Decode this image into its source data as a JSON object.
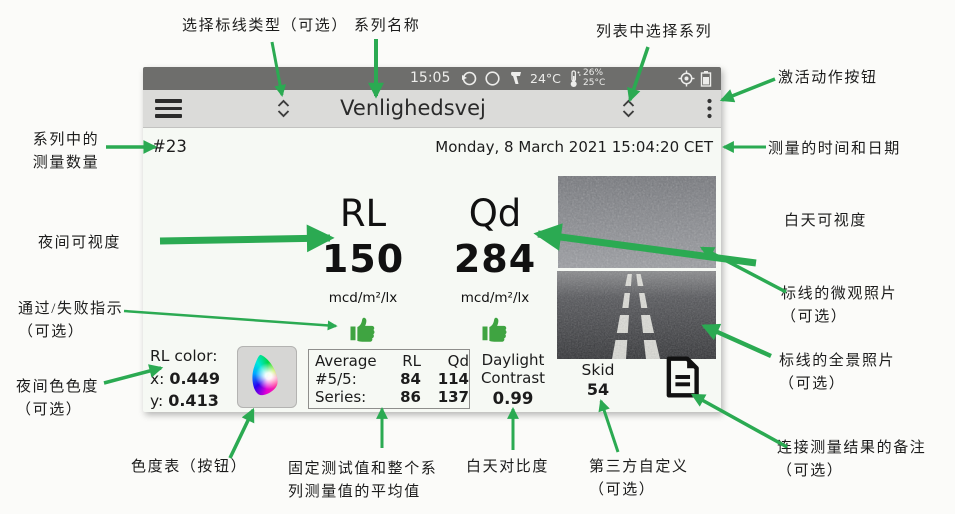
{
  "colors": {
    "arrow": "#2baa52",
    "thumb": "#3fa441",
    "status_bar_bg": "#6e6e6c",
    "menu_bar_bg": "#dbdbd9",
    "screen_bg": "#f6f9f4"
  },
  "icons": {
    "hamburger": "menu",
    "updown_selector": "chevron-up-down",
    "overflow": "vertical-dots",
    "sync": "circular-arrow",
    "mode": "circle",
    "ir_thermometer": "ir-gun",
    "thermometer": "thermometer",
    "gps": "target",
    "battery": "battery",
    "pass": "thumb-up",
    "chromaticity": "cie-horseshoe",
    "notes": "document"
  },
  "device": {
    "status_bar": {
      "time": "15:05",
      "ambient_temp": "24°C",
      "humidity": "26%",
      "road_temp": "25°C"
    },
    "menu_bar": {
      "title": "Venlighedsvej"
    },
    "header": {
      "count": "#23",
      "datetime": "Monday, 8 March 2021 15:04:20 CET"
    },
    "readings": {
      "rl": {
        "label": "RL",
        "value": "150",
        "unit": "mcd/m²/lx"
      },
      "qd": {
        "label": "Qd",
        "value": "284",
        "unit": "mcd/m²/lx"
      }
    },
    "rl_color": {
      "title": "RL color:",
      "x_label": "x:",
      "x_value": "0.449",
      "y_label": "y:",
      "y_value": "0.413"
    },
    "average": {
      "header": {
        "c0": "Average",
        "c1": "RL",
        "c2": "Qd"
      },
      "row1": {
        "label": "#5/5:",
        "rl": "84",
        "qd": "114"
      },
      "row2": {
        "label": "Series:",
        "rl": "86",
        "qd": "137"
      }
    },
    "daylight": {
      "line1": "Daylight",
      "line2": "Contrast",
      "value": "0.99"
    },
    "skid": {
      "label": "Skid",
      "value": "54"
    }
  },
  "annotations": {
    "select_marking_type": "选择标线类型（可选）",
    "series_name": "系列名称",
    "select_series": "列表中选择系列",
    "action_button": "激活动作按钮",
    "series_count": "系列中的\n测量数量",
    "night_visibility": "夜间可视度",
    "pass_fail": "通过/失败指示\n（可选）",
    "night_color": "夜间色色度\n（可选）",
    "measurement_datetime": "测量的时间和日期",
    "day_visibility": "白天可视度",
    "micro_photo": "标线的微观照片\n（可选）",
    "pano_photo": "标线的全景照片\n（可选）",
    "chroma_chart_button": "色度表（按钮）",
    "fixed_and_series_average": "固定测试值和整个系\n列测量值的平均值",
    "daylight_contrast": "白天对比度",
    "third_party_custom": "第三方自定义\n（可选）",
    "measurement_notes": "连接测量结果的备注\n（可选）"
  }
}
